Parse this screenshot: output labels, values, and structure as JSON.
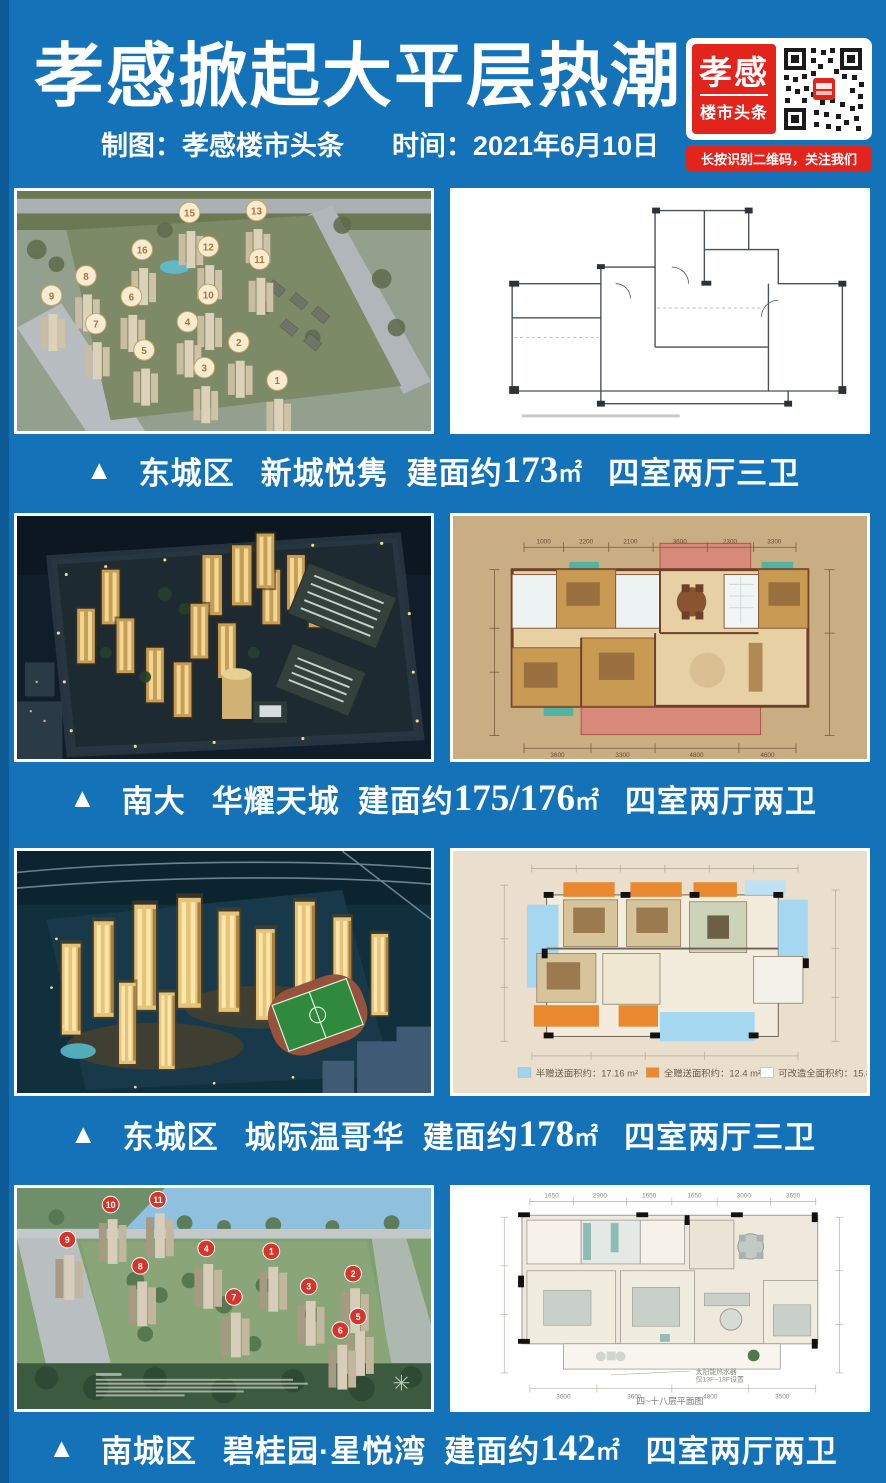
{
  "page": {
    "background": "#1472b8",
    "edge": "#0d5a97"
  },
  "header": {
    "title": "孝感掀起大平层热潮",
    "credit": "制图：孝感楼市头条",
    "date": "时间：2021年6月10日",
    "qr": {
      "logo_top": "孝感",
      "logo_bottom": "楼市头条",
      "caption": "长按识别二维码，关注我们",
      "brand_red": "#e2241d"
    }
  },
  "listings": [
    {
      "marker": "▲",
      "district": "东城区",
      "name": "新城悦隽",
      "area_prefix": "建面约",
      "area_value": "173",
      "area_unit": "㎡",
      "layout": "四室两厅三卫",
      "photo_badges": [
        "15",
        "13",
        "16",
        "12",
        "11",
        "8",
        "9",
        "6",
        "10",
        "7",
        "4",
        "2",
        "5",
        "3",
        "1"
      ]
    },
    {
      "marker": "▲",
      "district": "南大",
      "name": "华耀天城",
      "area_prefix": "建面约",
      "area_value": "175/176",
      "area_unit": "㎡",
      "layout": "四室两厅两卫",
      "plan_dims_top": [
        "1000",
        "2200",
        "2100",
        "3600",
        "2300",
        "3300"
      ],
      "plan_dims_bottom": [
        "3600",
        "3300",
        "4800",
        "4600"
      ]
    },
    {
      "marker": "▲",
      "district": "东城区",
      "name": "城际温哥华",
      "area_prefix": "建面约",
      "area_value": "178",
      "area_unit": "㎡",
      "layout": "四室两厅三卫",
      "plan_legend": [
        {
          "color": "#9fd4ee",
          "label": "半赠送面积约：17.16 m²"
        },
        {
          "color": "#e8882f",
          "label": "全赠送面积约：12.4 m²"
        },
        {
          "color": "#ffffff",
          "label": "可改造全面积约：15.84m²"
        }
      ]
    },
    {
      "marker": "▲",
      "district": "南城区",
      "name": "碧桂园·星悦湾",
      "area_prefix": "建面约",
      "area_value": "142",
      "area_unit": "㎡",
      "layout": "四室两厅两卫",
      "photo_badges": [
        "10",
        "11",
        "9",
        "8",
        "4",
        "1",
        "3",
        "2",
        "7",
        "5",
        "6"
      ],
      "plan_note_line1": "太阳能热水器",
      "plan_note_line2": "仅13F~18F设置",
      "plan_caption": "四~十八层平面图",
      "plan_dims_top": [
        "1650",
        "2900",
        "1650",
        "1650",
        "3000",
        "3650"
      ],
      "plan_dims_bottom": [
        "3600",
        "3600",
        "4800",
        "3500"
      ]
    }
  ]
}
